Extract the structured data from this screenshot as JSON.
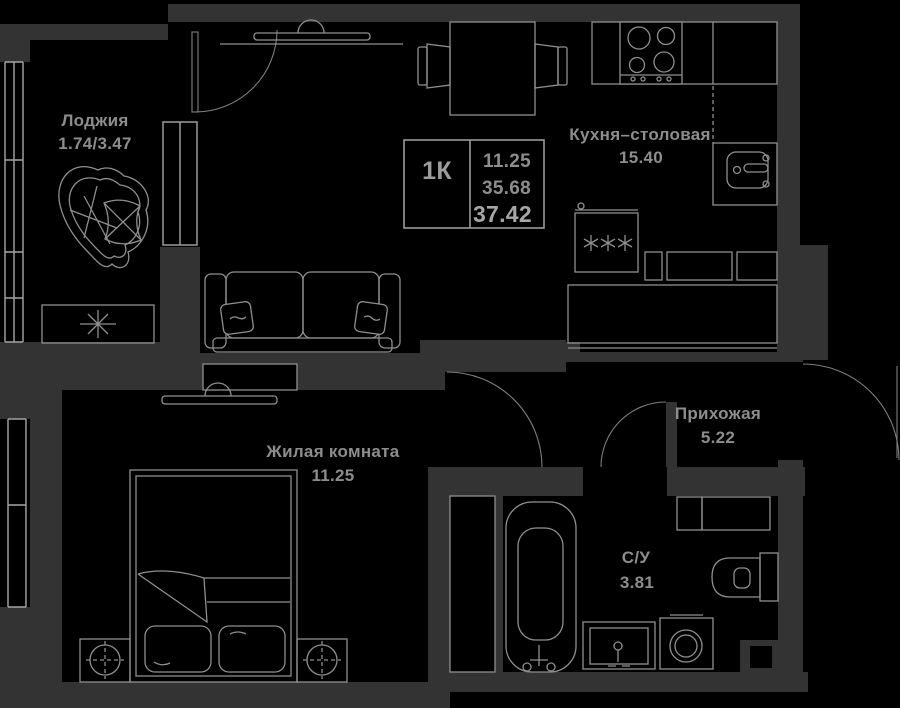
{
  "plan": {
    "layout_label": "1К",
    "areas": {
      "room_area": "11.25",
      "total_area": "35.68",
      "total_with_loggia": "37.42"
    }
  },
  "rooms": [
    {
      "id": "loggia",
      "name": "Лоджия",
      "area": "1.74/3.47"
    },
    {
      "id": "kitchen_dining",
      "name": "Кухня–столовая",
      "area": "15.40"
    },
    {
      "id": "living_room",
      "name": "Жилая комната",
      "area": "11.25"
    },
    {
      "id": "hallway",
      "name": "Прихожая",
      "area": "5.22"
    },
    {
      "id": "bathroom",
      "name": "С/У",
      "area": "3.81"
    }
  ],
  "colors": {
    "background": "#000000",
    "wall": "#333333",
    "line": "#8f8f8f",
    "text": "#8d8d8d"
  }
}
